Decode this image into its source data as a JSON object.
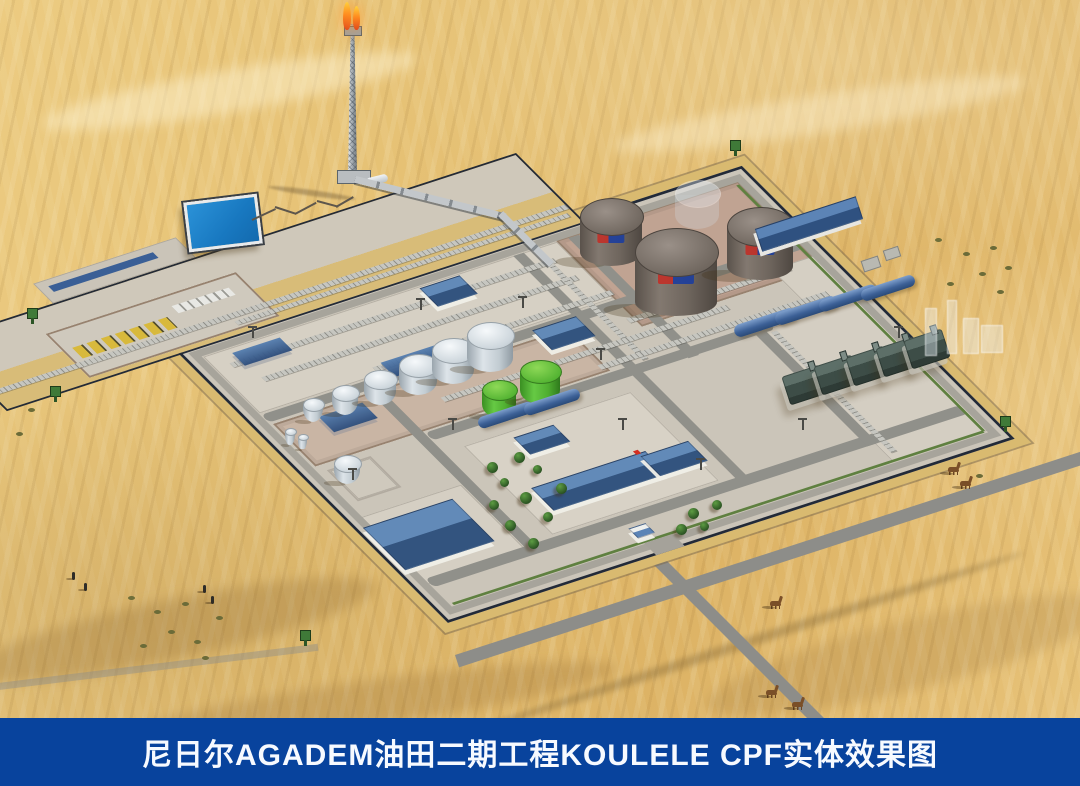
{
  "banner": {
    "title": "尼日尔AGADEM油田二期工程KOULELE CPF实体效果图",
    "background_color": "#08439d",
    "text_color": "#ffffff"
  },
  "scene": {
    "kind": "3d-aerial-rendering",
    "subject": "Desert oilfield central processing facility (CPF) compound",
    "environment": "sand dunes with camels, shrubs, figures and access roads",
    "palette": {
      "sand": "#e5c073",
      "sand_light": "#f2d792",
      "sand_shadow": "#c79e55",
      "concrete": "#cbc5b9",
      "road_gray": "#8d8d89",
      "tank_farm_ground": "#c0a392",
      "roof_blue": "#3a5f96",
      "crude_tank_gray": "#6e655e",
      "product_tank_white": "#ccd4da",
      "tank_green": "#54b637",
      "pond_blue": "#2383c8",
      "flame_orange": "#ff8c1f",
      "watchtower_green": "#3f7a38",
      "fence_dark": "#222a38",
      "berm_tan": "#d9ba70"
    },
    "features": [
      "flare-stack-with-twin-flames",
      "evaporation-pond",
      "crude-oil-tank-farm-three-tanks-plus-future-tank",
      "process-tank-row-six-white-two-green",
      "compressor-train-five-units",
      "manifold-with-yellow-pig-launchers",
      "pipe-racks",
      "camp-buildings-with-blue-roofs",
      "perimeter-fence-with-watchtowers",
      "main-gate-and-access-roads",
      "camels-shrubs-people-in-desert"
    ]
  }
}
